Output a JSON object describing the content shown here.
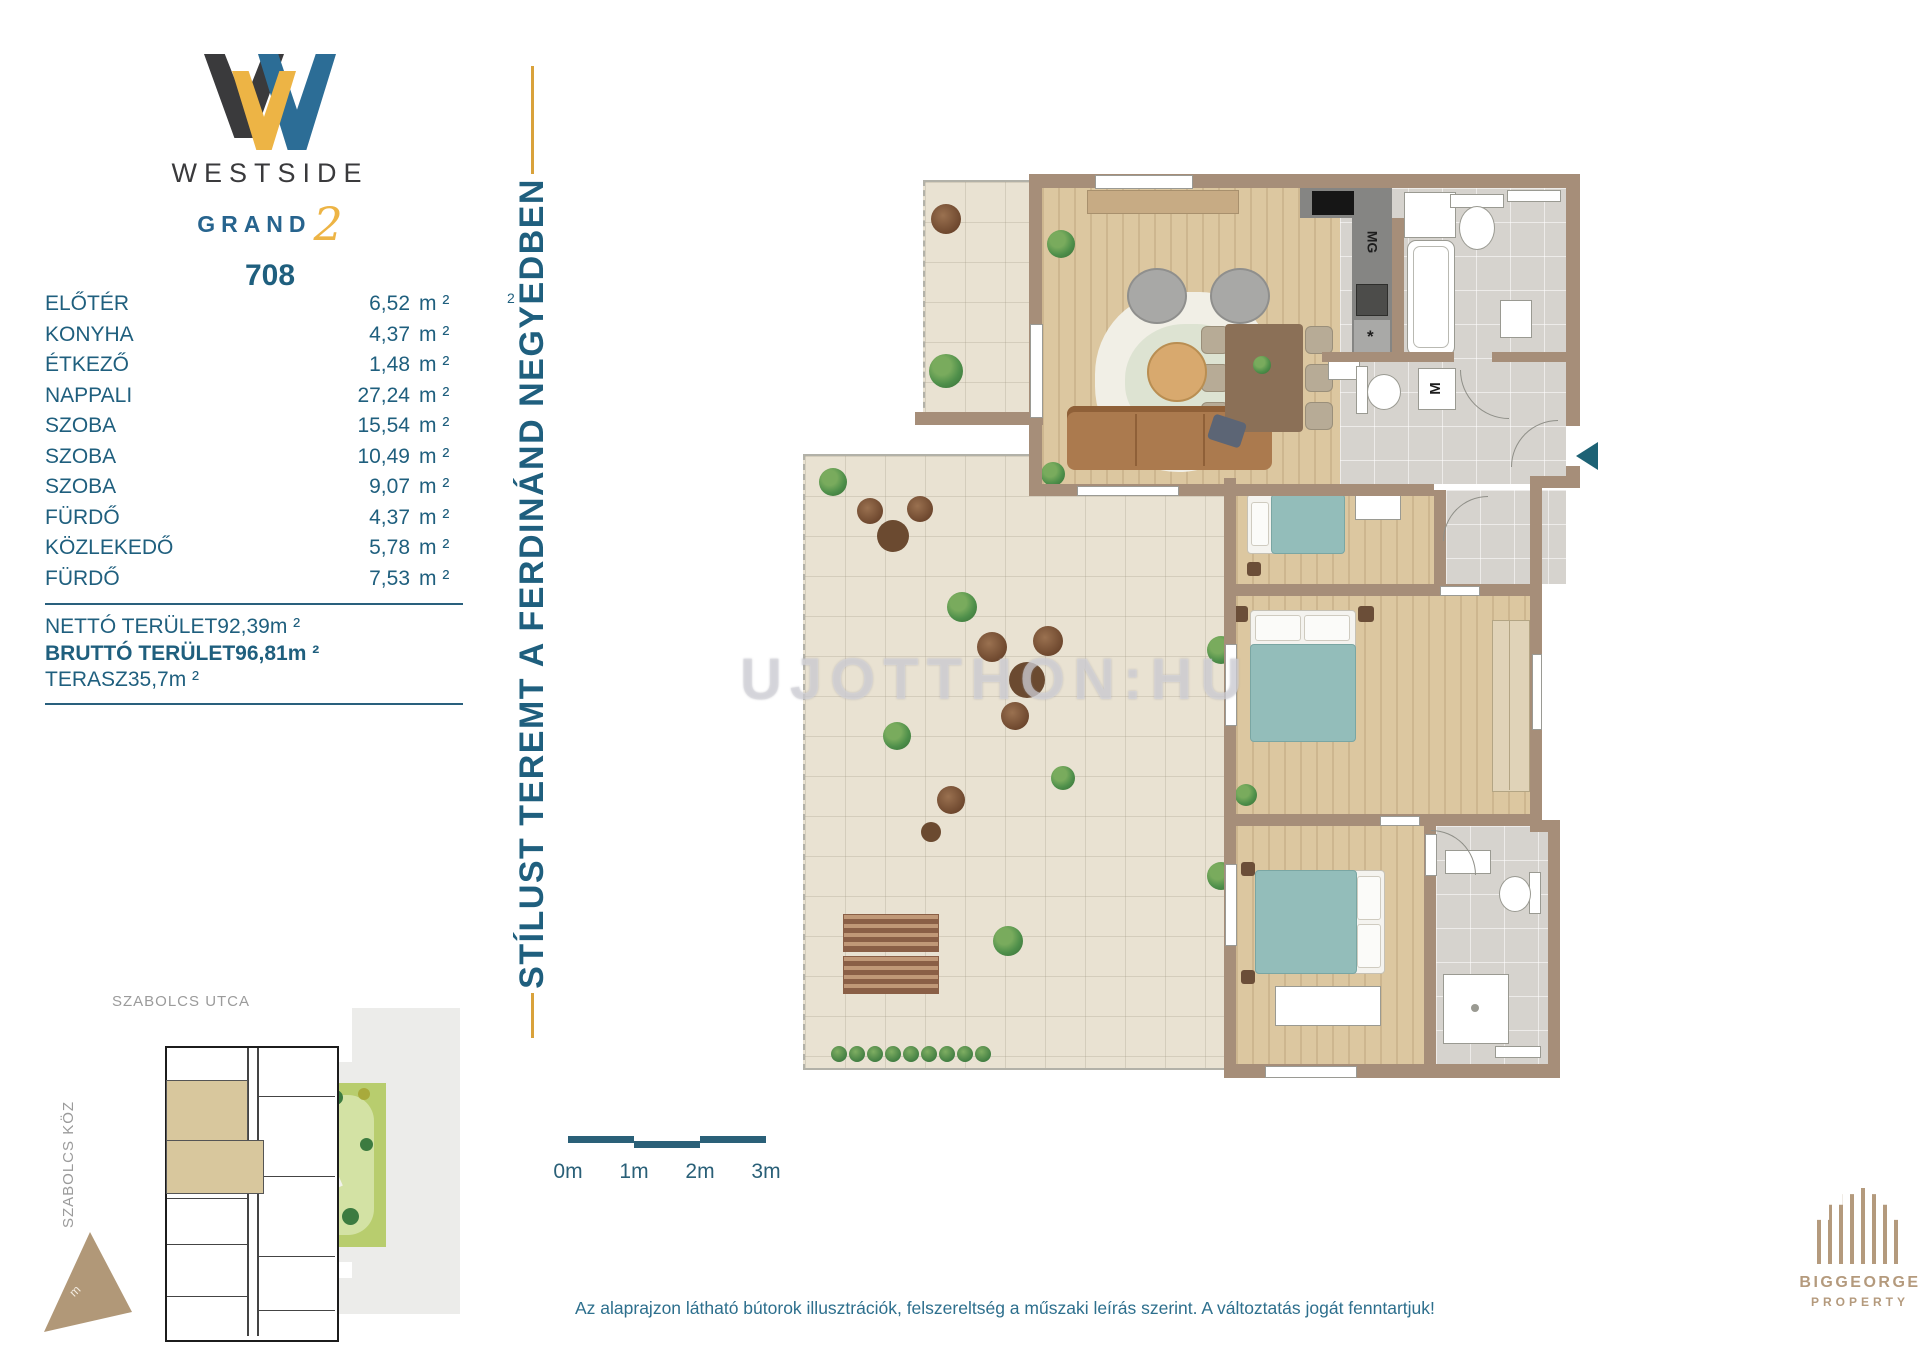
{
  "logo": {
    "title": "WESTSIDE",
    "subtitle": "GRAND",
    "script_number": "2",
    "unit_number": "708"
  },
  "vertical_banner": {
    "text": "STÍLUST TEREMT A FERDINÁND NEGYEDBEN"
  },
  "rooms": {
    "rows": [
      {
        "label": "ELŐTÉR",
        "value": "6,52",
        "unit": "m ²",
        "note": "2"
      },
      {
        "label": "KONYHA",
        "value": "4,37",
        "unit": "m ²"
      },
      {
        "label": "ÉTKEZŐ",
        "value": "1,48",
        "unit": "m ²"
      },
      {
        "label": "NAPPALI",
        "value": "27,24",
        "unit": "m ²"
      },
      {
        "label": "SZOBA",
        "value": "15,54",
        "unit": "m ²"
      },
      {
        "label": "SZOBA",
        "value": "10,49",
        "unit": "m ²"
      },
      {
        "label": "SZOBA",
        "value": "9,07",
        "unit": "m ²"
      },
      {
        "label": "FÜRDŐ",
        "value": "4,37",
        "unit": "m ²"
      },
      {
        "label": "KÖZLEKEDŐ",
        "value": "5,78",
        "unit": "m ²"
      },
      {
        "label": "FÜRDŐ",
        "value": "7,53",
        "unit": "m ²"
      }
    ],
    "totals": [
      {
        "label": "NETTÓ TERÜLET",
        "value": "92,39",
        "unit": "m ²"
      },
      {
        "label": "BRUTTÓ TERÜLET",
        "value": "96,81",
        "unit": "m ²"
      },
      {
        "label": "TERASZ",
        "value": "35,7",
        "unit": "m ²"
      }
    ]
  },
  "floorplan": {
    "watermark": "UJOTTHON:HU",
    "kitchen_hood_label": "MG",
    "washing_machine_label": "M",
    "dishwasher_label": "*"
  },
  "siteplan": {
    "street_top": "SZABOLCS UTCA",
    "street_left": "SZABOLCS KÖZ",
    "north_mark": "m"
  },
  "scale_bar": {
    "labels": [
      "0m",
      "1m",
      "2m",
      "3m"
    ]
  },
  "disclaimer": "Az alaprajzon látható bútorok illusztrációk, felszereltség a műszaki leírás szerint. A változtatás jogát fenntartjuk!",
  "developer_logo": {
    "line1": "BIGGEORGE",
    "line2": "PROPERTY"
  },
  "colors": {
    "teal": "#1f5f7e",
    "gold": "#d9a23b",
    "wall": "#a68e79",
    "tan": "#b49a7d"
  }
}
